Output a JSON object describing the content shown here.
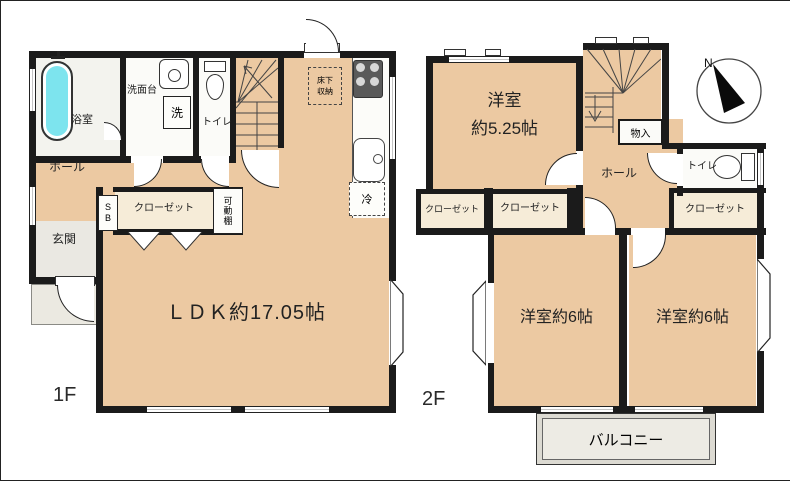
{
  "colors": {
    "wall": "#1b1b1b",
    "room": "#ecc9a2",
    "closet": "#f6ecd8",
    "wet": "#fbfbf8",
    "tub": "#7de4ee",
    "entrance": "#eae8e2",
    "balcony": "#edebe4"
  },
  "floor1": {
    "label": "1F",
    "rooms": {
      "bathroom": "浴室",
      "washstand": "洗面台",
      "washer": "洗",
      "toilet": "トイレ",
      "hall": "ホール",
      "entrance": "玄関",
      "shoe_box": "SB",
      "closet": "クローゼット",
      "movable_shelf": "可動棚",
      "underfloor_1": "床下",
      "underfloor_2": "収納",
      "fridge": "冷",
      "ldk": "ＬＤＫ約17.05帖"
    }
  },
  "floor2": {
    "label": "2F",
    "compass_n": "N",
    "rooms": {
      "bedroom_name": "洋室",
      "bedroom_size": "約5.25帖",
      "storage": "物入",
      "hall": "ホール",
      "toilet": "トイレ",
      "closet_left": "クローゼット",
      "closet_center": "クローゼット",
      "closet_right": "クローゼット",
      "bedroom_left": "洋室約6帖",
      "bedroom_right": "洋室約6帖",
      "balcony": "バルコニー"
    }
  }
}
